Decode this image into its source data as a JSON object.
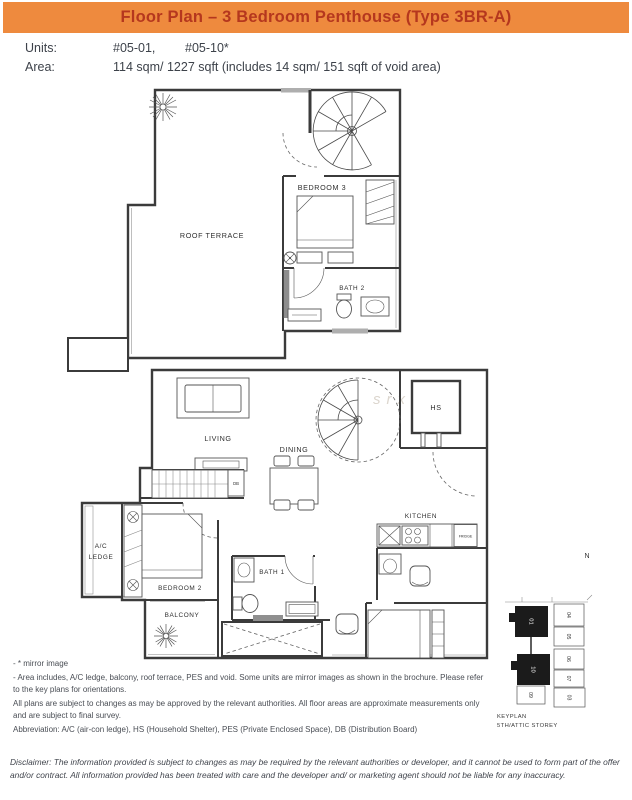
{
  "header": {
    "title": "Floor Plan – 3 Bedroom Penthouse (Type 3BR-A)"
  },
  "colors": {
    "banner_orange": "#EE8A3E",
    "title_red": "#B5371E"
  },
  "meta": {
    "units_label": "Units:",
    "unit_primary": "#05-01,",
    "unit_secondary": "#05-10*",
    "area_label": "Area:",
    "area_value": "114 sqm/ 1227 sqft (includes 14 sqm/ 151 sqft of void area)"
  },
  "plan_labels": {
    "roof_terrace": "ROOF TERRACE",
    "bedroom3": "BEDROOM 3",
    "bath2": "BATH 2",
    "living": "LIVING",
    "dining": "DINING",
    "kitchen": "KITCHEN",
    "fridge": "FRIDGE",
    "hs": "HS",
    "db": "DB",
    "ac_line1": "A/C",
    "ac_line2": "LEDGE",
    "bedroom2": "BEDROOM 2",
    "balcony": "BALCONY",
    "bath1": "BATH 1"
  },
  "watermark": "srx",
  "notes": {
    "mirror": "- * mirror image",
    "area_includes": "- Area includes, A/C ledge, balcony, roof terrace, PES and void. Some units are mirror images as shown in the brochure. Please refer to the key plans for orientations.",
    "plans_subject": "All plans are subject to changes as may be approved by the relevant authorities. All floor areas are approximate measurements only and are subject to final survey.",
    "abbreviation": "Abbreviation: A/C (air-con ledge), HS (Household Shelter), PES (Private Enclosed Space), DB (Distribution Board)"
  },
  "keyplan": {
    "north_label": "N",
    "caption_line1": "KEYPLAN",
    "caption_line2": "5TH/ATTIC STOREY",
    "highlighted_units": [
      "01",
      "10"
    ],
    "unit_numbers": [
      "04",
      "05",
      "06",
      "07",
      "03",
      "09"
    ]
  },
  "disclaimer": "Disclaimer: The information provided is subject to changes as may be required by the relevant authorities or developer, and it cannot be used to form part of the offer and/or contract. All information provided has been treated with care and the developer and/ or marketing agent should not be liable for any inaccuracy."
}
